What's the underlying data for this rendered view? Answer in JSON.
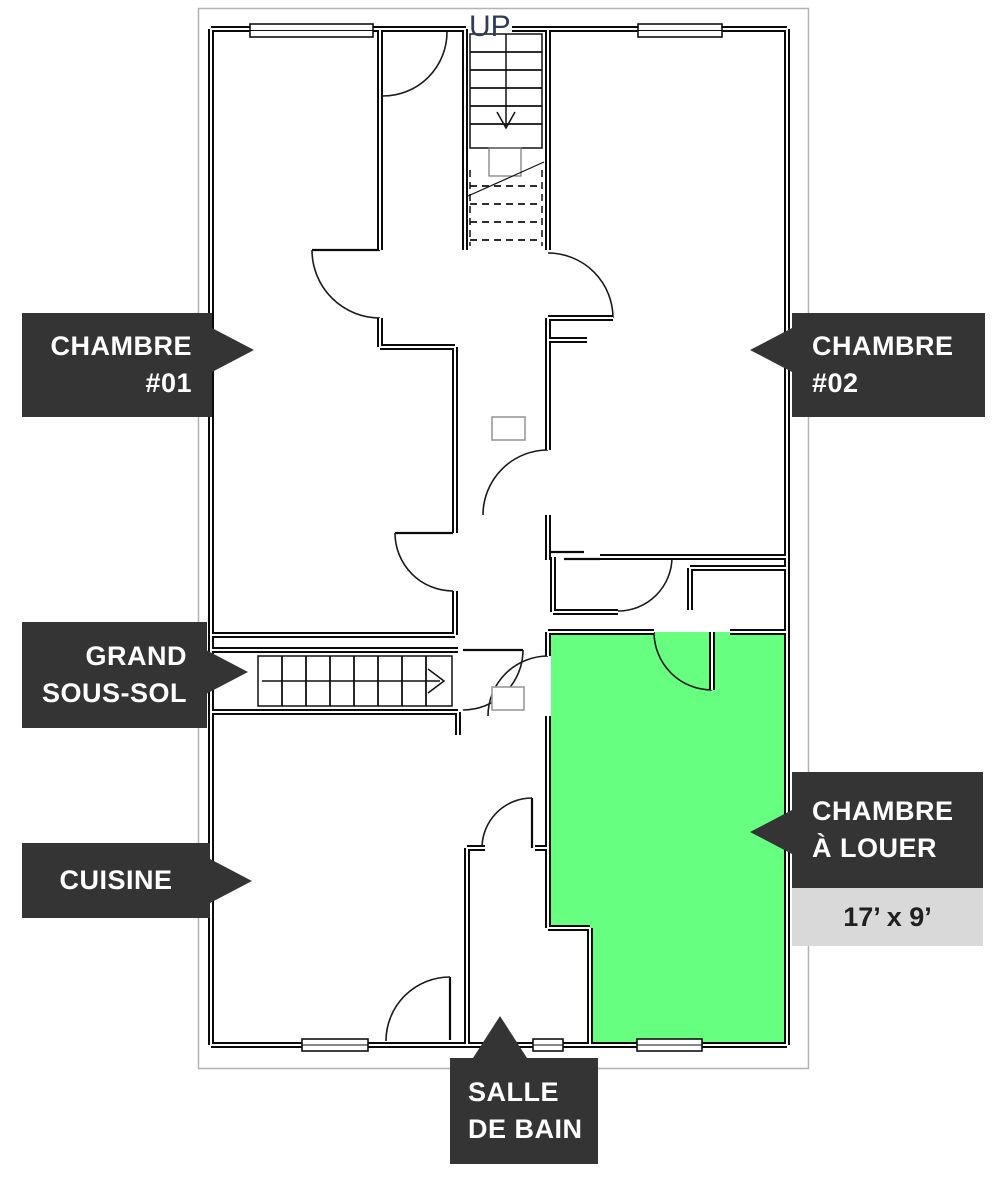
{
  "labels": {
    "chambre_01": {
      "line1": "CHAMBRE",
      "line2": "#01"
    },
    "chambre_02": {
      "line1": "CHAMBRE",
      "line2": "#02"
    },
    "grand_sous_sol": {
      "line1": "GRAND",
      "line2": "SOUS-SOL"
    },
    "cuisine": {
      "line1": "CUISINE"
    },
    "chambre_a_louer": {
      "line1": "CHAMBRE",
      "line2": "À LOUER"
    },
    "chambre_a_louer_size": "17’ x 9’",
    "salle_de_bain": {
      "line1": "SALLE",
      "line2": "DE BAIN"
    },
    "stairs_up": "UP"
  },
  "colors": {
    "highlight_room": "#66ff80",
    "label_background": "#343434",
    "label_text": "#ffffff",
    "size_tag_background": "#d9d9d9",
    "size_tag_text": "#1f1f1f",
    "frame_border": "#b3b3b3",
    "up_text": "#2e3c55",
    "wall": "#0a0a0a"
  }
}
